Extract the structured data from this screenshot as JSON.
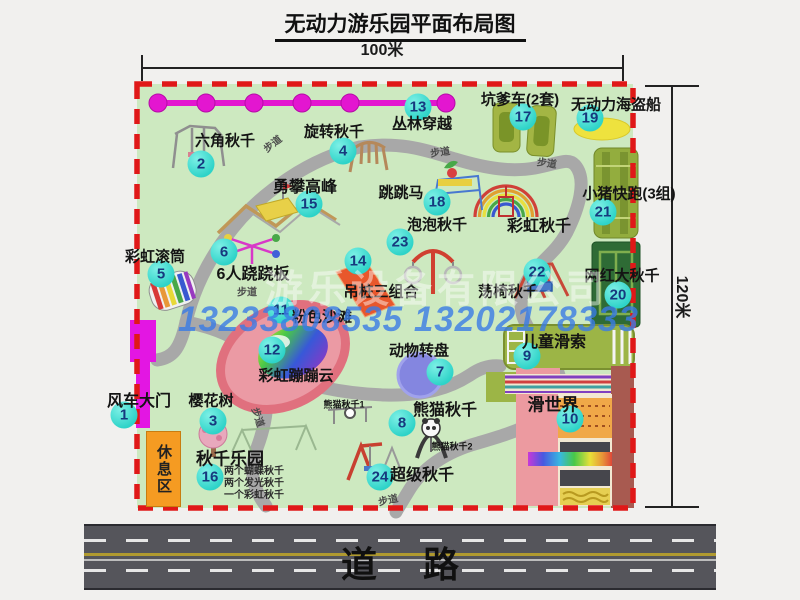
{
  "title": "无动力游乐园平面布局图",
  "dimensions": {
    "width_label": "100米",
    "height_label": "120米"
  },
  "road": {
    "label": "道路"
  },
  "watermark": {
    "company": "游乐设备有限公司",
    "phones": "13233808535 13202178333"
  },
  "rest_area": {
    "label": "休息区"
  },
  "colors": {
    "park_green": "#cde9c0",
    "border_red": "#e01818",
    "path_gray": "#a8a8a8",
    "badge_cyan": "#2ed3c8",
    "gate_magenta": "#e316e3",
    "chain_magenta": "#e316d0",
    "rest_orange": "#f59b22",
    "phone_blue": "#3a7ce6"
  },
  "map": {
    "attractions": [
      {
        "num": "1",
        "label": "风车大门",
        "bx": 124,
        "by": 415,
        "lx": 139,
        "ly": 399,
        "fs": 16
      },
      {
        "num": "2",
        "label": "六角秋千",
        "bx": 201,
        "by": 164,
        "lx": 225,
        "ly": 140
      },
      {
        "num": "3",
        "label": "樱花树",
        "bx": 213,
        "by": 421,
        "lx": 211,
        "ly": 400
      },
      {
        "num": "4",
        "label": "旋转秋千",
        "bx": 343,
        "by": 151,
        "lx": 334,
        "ly": 131
      },
      {
        "num": "5",
        "label": "彩虹滚筒",
        "bx": 161,
        "by": 274,
        "lx": 155,
        "ly": 256
      },
      {
        "num": "6",
        "label": "6人跷跷板",
        "bx": 224,
        "by": 252,
        "lx": 253,
        "ly": 272,
        "fs": 16
      },
      {
        "num": "7",
        "label": "动物转盘",
        "bx": 440,
        "by": 372,
        "lx": 419,
        "ly": 350
      },
      {
        "num": "8",
        "label": "熊猫秋千",
        "bx": 402,
        "by": 423,
        "lx": 445,
        "ly": 408,
        "fs": 16
      },
      {
        "num": "9",
        "label": "儿童滑索",
        "bx": 527,
        "by": 356,
        "lx": 554,
        "ly": 340,
        "fs": 16
      },
      {
        "num": "10",
        "label": "滑世界",
        "bx": 570,
        "by": 419,
        "lx": 553,
        "ly": 403,
        "fs": 17
      },
      {
        "num": "11",
        "label": "粉色沙滩",
        "bx": 281,
        "by": 310,
        "lx": 322,
        "ly": 316
      },
      {
        "num": "12",
        "label": "彩虹蹦蹦云",
        "bx": 272,
        "by": 350,
        "lx": 296,
        "ly": 375
      },
      {
        "num": "13",
        "label": "丛林穿越",
        "bx": 418,
        "by": 107,
        "lx": 422,
        "ly": 123
      },
      {
        "num": "14",
        "label": "吊桩三组合",
        "bx": 358,
        "by": 261,
        "lx": 381,
        "ly": 291
      },
      {
        "num": "15",
        "label": "勇攀高峰",
        "bx": 309,
        "by": 204,
        "lx": 305,
        "ly": 185,
        "fs": 16
      },
      {
        "num": "16",
        "label": "秋千乐园",
        "bx": 210,
        "by": 477,
        "lx": 230,
        "ly": 457,
        "fs": 17,
        "notes": [
          "两个蝴蝶秋千",
          "两个发光秋千",
          "一个彩虹秋千"
        ],
        "nx": 224,
        "ny": 466
      },
      {
        "num": "17",
        "label": "坑爹车(2套)",
        "bx": 523,
        "by": 117,
        "lx": 520,
        "ly": 99
      },
      {
        "num": "18",
        "label": "跳跳马",
        "bx": 437,
        "by": 202,
        "lx": 401,
        "ly": 192
      },
      {
        "num": "19",
        "label": "无动力海盗船",
        "bx": 590,
        "by": 118,
        "lx": 616,
        "ly": 104
      },
      {
        "num": "20",
        "label": "网红大秋千",
        "bx": 618,
        "by": 295,
        "lx": 622,
        "ly": 275
      },
      {
        "num": "21",
        "label": "小猪快跑(3组)",
        "bx": 603,
        "by": 212,
        "lx": 629,
        "ly": 193
      },
      {
        "num": "22",
        "label": "荡椅秋千",
        "bx": 537,
        "by": 272,
        "lx": 508,
        "ly": 291
      },
      {
        "num": "23",
        "label": "泡泡秋千",
        "bx": 400,
        "by": 242,
        "lx": 437,
        "ly": 224
      },
      {
        "num": "24",
        "label": "超级秋千",
        "bx": 380,
        "by": 477,
        "lx": 422,
        "ly": 473,
        "fs": 16
      }
    ],
    "extra_labels": [
      {
        "text": "彩虹秋千",
        "x": 539,
        "y": 224,
        "fs": 16
      },
      {
        "text": "熊猫秋千1",
        "x": 344,
        "y": 404,
        "fs": 9
      },
      {
        "text": "熊猫秋千2",
        "x": 452,
        "y": 446,
        "fs": 9
      }
    ],
    "path_labels": [
      {
        "text": "步道",
        "x": 272,
        "y": 143,
        "rot": -38
      },
      {
        "text": "步道",
        "x": 440,
        "y": 151,
        "rot": -8
      },
      {
        "text": "步道",
        "x": 547,
        "y": 162,
        "rot": 8
      },
      {
        "text": "步道",
        "x": 247,
        "y": 291,
        "rot": 0
      },
      {
        "text": "步道",
        "x": 259,
        "y": 417,
        "rot": 72
      },
      {
        "text": "步道",
        "x": 388,
        "y": 499,
        "rot": -12
      }
    ]
  }
}
